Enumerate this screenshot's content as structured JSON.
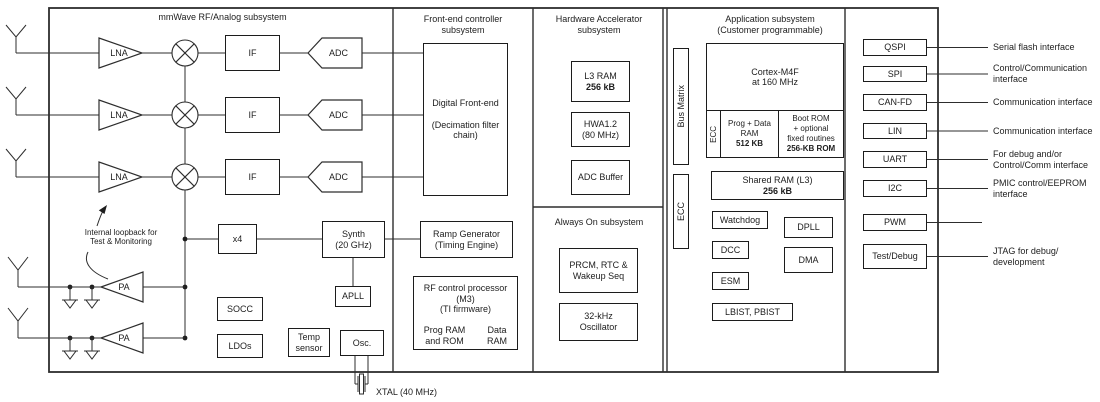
{
  "sections": {
    "mmwave": {
      "title": "mmWave RF/Analog subsystem",
      "lna_label": "LNA",
      "pa_label": "PA",
      "if_label": "IF",
      "adc_label": "ADC",
      "loopback_note": "Internal loopback for\nTest & Monitoring",
      "x4_label": "x4",
      "synth_label": "Synth\n(20 GHz)",
      "apll_label": "APLL",
      "socc_label": "SOCC",
      "ldos_label": "LDOs",
      "temp_label": "Temp\nsensor",
      "osc_label": "Osc.",
      "xtal_label": "XTAL (40 MHz)"
    },
    "frontend": {
      "title": "Front-end controller\nsubsystem",
      "dfe_label": "Digital Front-end\n\n(Decimation filter\nchain)",
      "ramp_label": "Ramp Generator\n(Timing Engine)",
      "rfproc_label": "RF control processor\n(M3)\n(TI firmware)",
      "prog_ram_label": "Prog RAM\nand ROM",
      "data_ram_label": "Data\nRAM"
    },
    "hwa": {
      "title": "Hardware Accelerator\nsubsystem",
      "l3ram_name": "L3 RAM",
      "l3ram_size": "256 kB",
      "hwa_label": "HWA1.2\n(80 MHz)",
      "adc_buffer_label": "ADC Buffer"
    },
    "alwayson": {
      "title": "Always On subsystem",
      "prcm_label": "PRCM, RTC &\nWakeup Seq",
      "osc32k_label": "32-kHz\nOscillator"
    },
    "app": {
      "title": "Application subsystem\n(Customer programmable)",
      "bus_matrix_label": "Bus Matrix",
      "ecc_side_label": "ECC",
      "cortex_label": "Cortex-M4F\nat 160 MHz",
      "ecc_cell_label": "ECC",
      "prog_data_ram_name": "Prog + Data\nRAM",
      "prog_data_ram_size": "512 KB",
      "boot_rom_name": "Boot ROM\n+ optional\nfixed routines",
      "boot_rom_size": "256-KB ROM",
      "shared_ram_name": "Shared RAM (L3)",
      "shared_ram_size": "256 kB",
      "watchdog_label": "Watchdog",
      "dpll_label": "DPLL",
      "dcc_label": "DCC",
      "dma_label": "DMA",
      "esm_label": "ESM",
      "lbist_label": "LBIST, PBIST"
    },
    "interfaces": {
      "items": [
        {
          "label": "QSPI",
          "note": "Serial flash interface"
        },
        {
          "label": "SPI",
          "note": "Control/Communication\ninterface"
        },
        {
          "label": "CAN-FD",
          "note": "Communication interface"
        },
        {
          "label": "LIN",
          "note": "Communication interface"
        },
        {
          "label": "UART",
          "note": "For debug and/or\nControl/Comm interface"
        },
        {
          "label": "I2C",
          "note": "PMIC control/EEPROM\ninterface"
        },
        {
          "label": "PWM",
          "note": ""
        },
        {
          "label": "Test/Debug",
          "note": "JTAG for debug/\ndevelopment"
        }
      ]
    }
  },
  "colors": {
    "line": "#2d2d2d",
    "text": "#1d1d1d",
    "background": "#ffffff"
  }
}
